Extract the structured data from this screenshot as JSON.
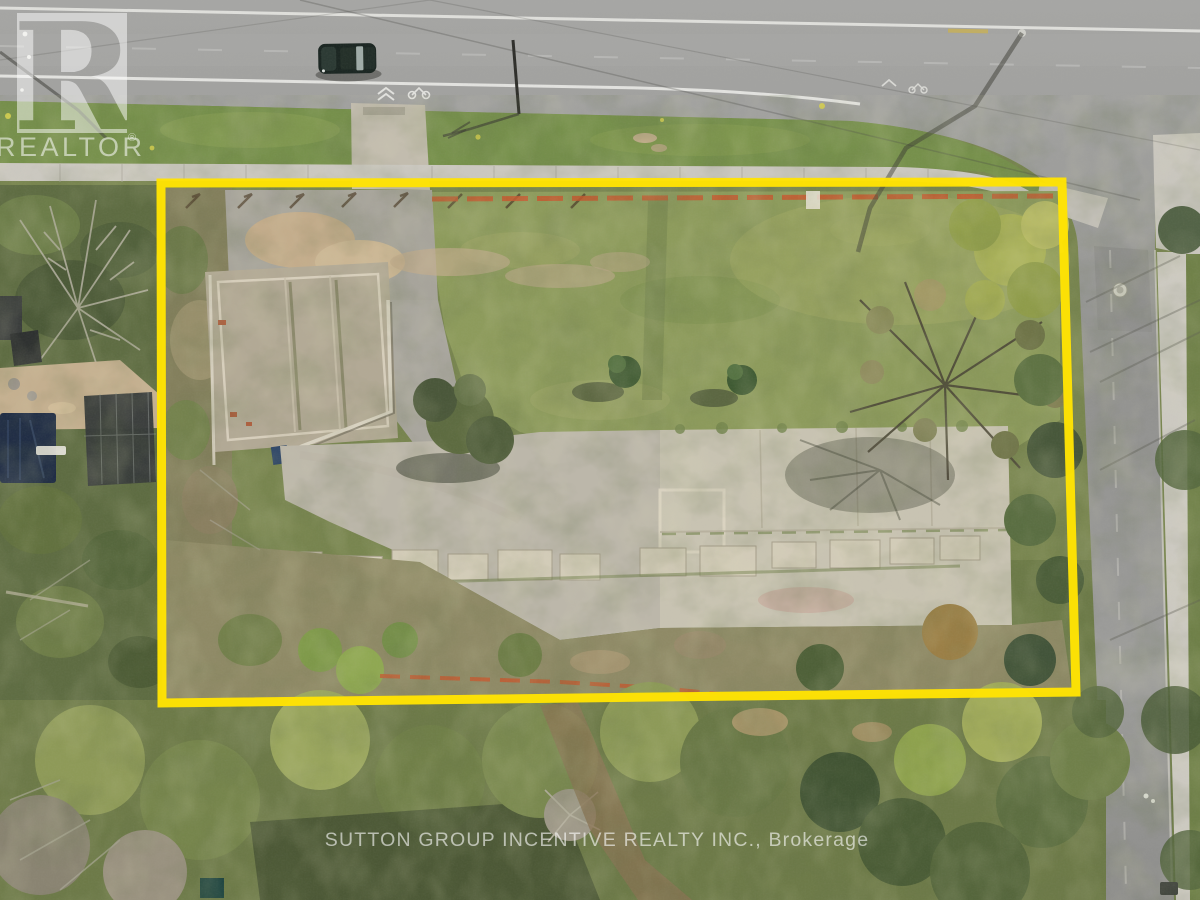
{
  "watermarks": {
    "logo": {
      "letter": "R",
      "name": "REALTOR",
      "registered": "®"
    },
    "brokerage": "SUTTON GROUP INCENTIVE REALTY INC., Brokerage"
  },
  "colors": {
    "boundary_yellow": "#FFE303",
    "silt_fence_orange": "#C4582E",
    "watermark_white": "#FFFFFF"
  }
}
